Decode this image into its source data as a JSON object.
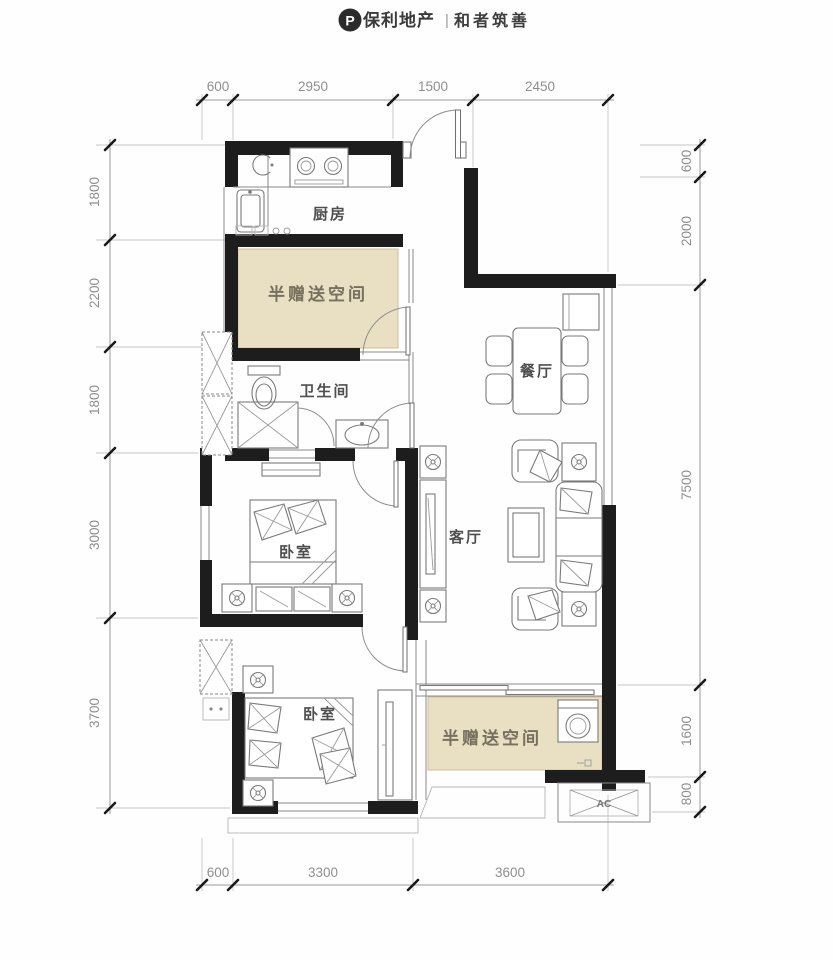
{
  "header": {
    "logo_mark": "P",
    "brand": "保利地产",
    "divider": "|",
    "slogan": "和者筑善"
  },
  "rooms": {
    "kitchen": "厨房",
    "bonus_space_top": "半赠送空间",
    "bathroom": "卫生间",
    "dining": "餐厅",
    "living": "客厅",
    "bedroom_main": "卧室",
    "bedroom_second": "卧室",
    "bonus_space_bottom": "半赠送空间",
    "ac_unit": "AC"
  },
  "dimensions": {
    "top": [
      "600",
      "2950",
      "1500",
      "2450"
    ],
    "bottom": [
      "600",
      "3300",
      "3600"
    ],
    "left": [
      "1800",
      "2200",
      "1800",
      "3000",
      "3700"
    ],
    "right": [
      "600",
      "2000",
      "7500",
      "1600",
      "800"
    ]
  },
  "colors": {
    "wall": "#1d1d1d",
    "bonus_fill": "#e9dfc3",
    "dim_text": "#8f8f8f",
    "label_text": "#4f4f4f"
  }
}
